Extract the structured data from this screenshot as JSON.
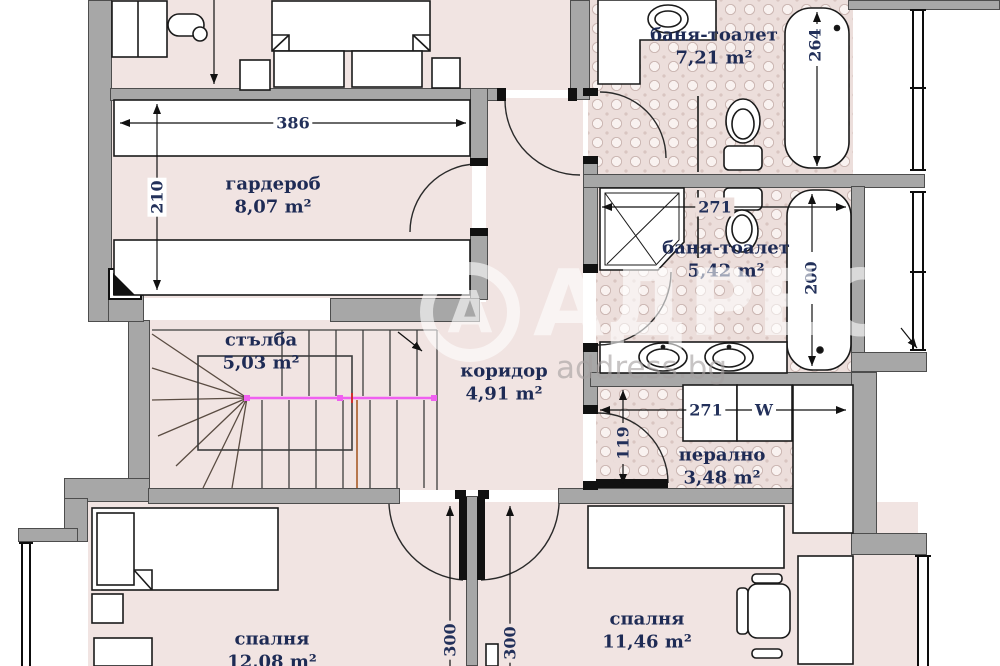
{
  "watermark": {
    "logo_letter": "А",
    "brand": "АДРЕС",
    "site": "address.bg"
  },
  "rooms": {
    "bathroom_top": {
      "name": "баня-тоалет",
      "area": "7,21 m²"
    },
    "wardrobe": {
      "name": "гардероб",
      "area": "8,07 m²"
    },
    "bathroom_mid": {
      "name": "баня-тоалет",
      "area": "5,42 m²"
    },
    "stairs": {
      "name": "стълба",
      "area": "5,03 m²"
    },
    "corridor": {
      "name": "коридор",
      "area": "4,91 m²"
    },
    "laundry": {
      "name": "перално",
      "area": "3,48 m²"
    },
    "bedroom_left": {
      "name": "спалня",
      "area": "12,08 m²"
    },
    "bedroom_right": {
      "name": "спалня",
      "area": "11,46 m²"
    }
  },
  "dimensions": {
    "wardrobe_width": "386",
    "wardrobe_depth": "210",
    "bathtub_top": "264",
    "bathtub_mid": "200",
    "bathroom_mid_width": "271",
    "laundry_width": "271",
    "laundry_door": "119",
    "bedroom_left_door": "300",
    "bedroom_right_door": "300"
  },
  "appliances": {
    "washer_label": "W"
  },
  "colors": {
    "floor": "#f1e4e2",
    "tile_base": "#ecdedb",
    "wall": "#a7a7a7",
    "label_text": "#1e2b55",
    "stair_rail": "#f060f0",
    "stair_handrail": "#b06a3c"
  }
}
